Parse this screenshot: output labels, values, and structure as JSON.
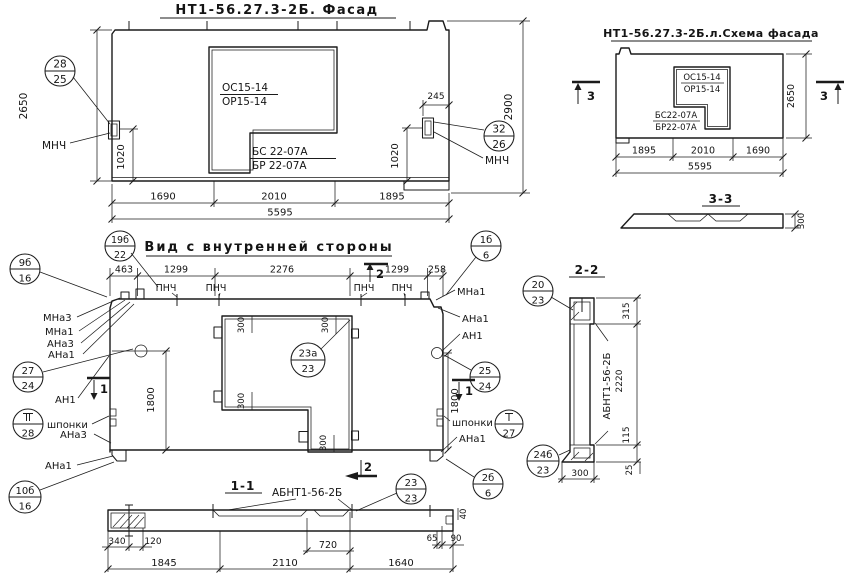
{
  "ink": "#1b1b1b",
  "paper": "#ffffff",
  "facade": {
    "title": "НТ1-56.27.3-2Б. Фасад",
    "window_top": "ОС15-14",
    "window_bot": "ОР15-14",
    "door_top": "БС 22-07А",
    "door_bot": "БР 22-07А",
    "callout_left_num": "28",
    "callout_left_den": "25",
    "callout_right_num": "32",
    "callout_right_den": "26",
    "mnch_left": "МНЧ",
    "mnch_right": "МНЧ",
    "dim_h_left": "2650",
    "dim_h_right": "2900",
    "dim_245": "245",
    "dim_1020_l": "1020",
    "dim_1020_r": "1020",
    "dim_b1": "1690",
    "dim_b2": "2010",
    "dim_b3": "1895",
    "dim_total": "5595"
  },
  "schema": {
    "title": "НТ1-56.27.3-2Б.л.Схема фасада",
    "window_top": "ОС15-14",
    "window_bot": "ОР15-14",
    "door_top": "БС22-07А",
    "door_bot": "БР22-07А",
    "marker_left": "3",
    "marker_right": "3",
    "dim_h": "2650",
    "dim_b1": "1895",
    "dim_b2": "2010",
    "dim_b3": "1690",
    "dim_total": "5595",
    "sec_title": "3-3",
    "sec_dim": "300"
  },
  "inner": {
    "title": "Вид с внутренней стороны",
    "callout_title_num": "19б",
    "callout_title_den": "22",
    "dt1": "463",
    "dt2": "1299",
    "dt3": "2276",
    "dt4": "1299",
    "dt5": "258",
    "pnch1": "ПНЧ",
    "pnch2": "ПНЧ",
    "pnch3": "ПНЧ",
    "pnch4": "ПНЧ",
    "marker_top": "2",
    "marker_bottom": "2",
    "marker_left": "1",
    "marker_right": "1",
    "dim_h_l": "1800",
    "dim_h_r": "1800",
    "d300_1": "300",
    "d300_2": "300",
    "d300_3": "300",
    "d300_4": "300",
    "callout_open_num": "23а",
    "callout_open_den": "23",
    "l_c9_num": "9б",
    "l_c9_den": "16",
    "l_mna3": "МНа3",
    "l_mna1": "МНа1",
    "l_ana3": "АНа3",
    "l_ana1": "АНа1",
    "l_c27_num": "27",
    "l_c27_den": "24",
    "l_an1": "АН1",
    "l_key_num": "II",
    "l_key_den": "28",
    "l_keys": "шпонки",
    "l_ana3b": "АНа3",
    "l_ana1b": "АНа1",
    "l_c10_num": "10б",
    "l_c10_den": "16",
    "r_c1_num": "1б",
    "r_c1_den": "6",
    "r_mna1": "МНа1",
    "r_ana1": "АНа1",
    "r_an1": "АН1",
    "r_c25_num": "25",
    "r_c25_den": "24",
    "r_keys": "шпонки",
    "r_key_num": "I",
    "r_key_den": "27",
    "r_ana1b": "АНа1",
    "r_c2_num": "2б",
    "r_c2_den": "6"
  },
  "sec11": {
    "title": "1-1",
    "label": "АБНТ1-56-2Б",
    "callout_num": "23",
    "callout_den": "23",
    "d340": "340",
    "d120": "120",
    "d720": "720",
    "d65": "65",
    "d90": "90",
    "d40": "40",
    "db1": "1845",
    "db2": "2110",
    "db3": "1640"
  },
  "sec22": {
    "title": "2-2",
    "label": "АБНТ1-56-2Б",
    "c_top_num": "20",
    "c_top_den": "23",
    "c_bot_num": "24б",
    "c_bot_den": "23",
    "d315": "315",
    "d2220": "2220",
    "d115": "115",
    "d25": "25",
    "d300": "300"
  }
}
